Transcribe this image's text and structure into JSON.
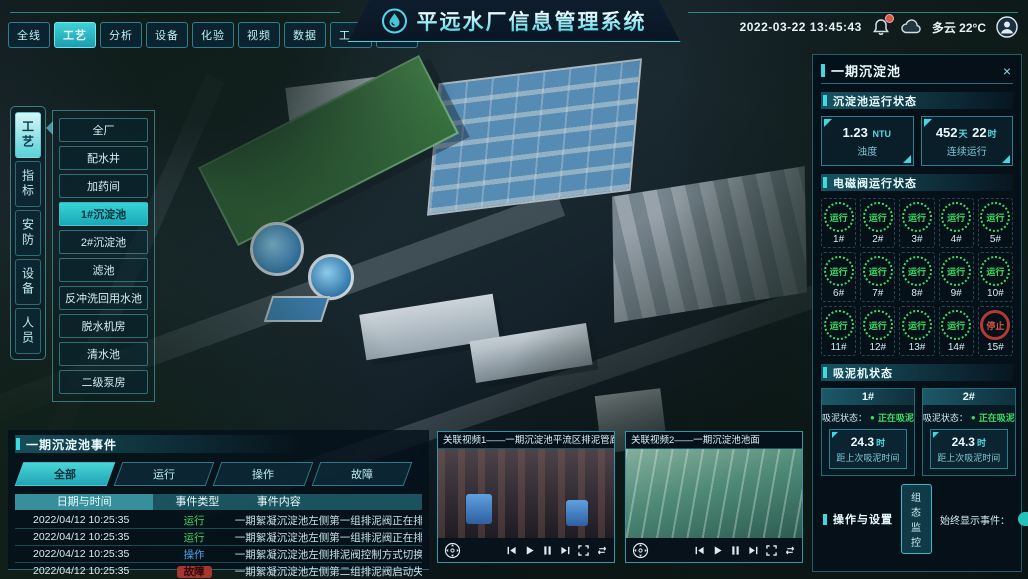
{
  "top_nav": {
    "tabs": [
      {
        "label": "全线",
        "active": false
      },
      {
        "label": "工艺",
        "active": true
      },
      {
        "label": "分析",
        "active": false
      },
      {
        "label": "设备",
        "active": false
      },
      {
        "label": "化验",
        "active": false
      },
      {
        "label": "视频",
        "active": false
      },
      {
        "label": "数据",
        "active": false
      },
      {
        "label": "工单",
        "active": false
      },
      {
        "label": "系统",
        "active": false
      }
    ],
    "title": "平远水厂信息管理系统",
    "datetime": "2022-03-22 13:45:43",
    "weather": "多云 22°C"
  },
  "left_nav": {
    "tabs": [
      {
        "label": "工艺",
        "active": true
      },
      {
        "label": "指标",
        "active": false
      },
      {
        "label": "安防",
        "active": false
      },
      {
        "label": "设备",
        "active": false
      },
      {
        "label": "人员",
        "active": false
      }
    ],
    "submenu": [
      {
        "label": "全厂",
        "active": false
      },
      {
        "label": "配水井",
        "active": false
      },
      {
        "label": "加药间",
        "active": false
      },
      {
        "label": "1#沉淀池",
        "active": true
      },
      {
        "label": "2#沉淀池",
        "active": false
      },
      {
        "label": "滤池",
        "active": false
      },
      {
        "label": "反冲洗回用水池",
        "active": false
      },
      {
        "label": "脱水机房",
        "active": false
      },
      {
        "label": "清水池",
        "active": false
      },
      {
        "label": "二级泵房",
        "active": false
      }
    ]
  },
  "right_panel": {
    "title": "一期沉淀池",
    "tank_status": {
      "title": "沉淀池运行状态",
      "turbidity": {
        "value": "1.23",
        "unit": "NTU",
        "label": "浊度"
      },
      "runtime": {
        "v1": "452",
        "u1": "天",
        "v2": "22",
        "u2": "时",
        "label": "连续运行"
      }
    },
    "valves": {
      "title": "电磁阀运行状态",
      "items": [
        {
          "id": "1#",
          "state": "运行",
          "status": "run"
        },
        {
          "id": "2#",
          "state": "运行",
          "status": "run"
        },
        {
          "id": "3#",
          "state": "运行",
          "status": "run"
        },
        {
          "id": "4#",
          "state": "运行",
          "status": "run"
        },
        {
          "id": "5#",
          "state": "运行",
          "status": "run"
        },
        {
          "id": "6#",
          "state": "运行",
          "status": "run"
        },
        {
          "id": "7#",
          "state": "运行",
          "status": "run"
        },
        {
          "id": "8#",
          "state": "运行",
          "status": "run"
        },
        {
          "id": "9#",
          "state": "运行",
          "status": "run"
        },
        {
          "id": "10#",
          "state": "运行",
          "status": "run"
        },
        {
          "id": "11#",
          "state": "运行",
          "status": "run"
        },
        {
          "id": "12#",
          "state": "运行",
          "status": "run"
        },
        {
          "id": "13#",
          "state": "运行",
          "status": "run"
        },
        {
          "id": "14#",
          "state": "运行",
          "status": "run"
        },
        {
          "id": "15#",
          "state": "停止",
          "status": "stop"
        }
      ]
    },
    "mud_suckers": {
      "title": "吸泥机状态",
      "items": [
        {
          "id": "1#",
          "state_label": "吸泥状态：",
          "state": "正在吸泥",
          "value": "24.3",
          "unit": "时",
          "label": "距上次吸泥时间"
        },
        {
          "id": "2#",
          "state_label": "吸泥状态：",
          "state": "正在吸泥",
          "value": "24.3",
          "unit": "时",
          "label": "距上次吸泥时间"
        }
      ]
    },
    "operations": {
      "title": "操作与设置",
      "button": "组态监控",
      "toggle_label": "始终显示事件：",
      "toggle_on": true
    }
  },
  "events_panel": {
    "title": "一期沉淀池事件",
    "tabs": [
      {
        "label": "全部",
        "active": true
      },
      {
        "label": "运行",
        "active": false
      },
      {
        "label": "操作",
        "active": false
      },
      {
        "label": "故障",
        "active": false
      }
    ],
    "columns": {
      "time": "日期与时间",
      "type": "事件类型",
      "content": "事件内容"
    },
    "rows": [
      {
        "time": "2022/04/12 10:25:35",
        "type": "运行",
        "status": "run",
        "content": "一期絮凝沉淀池左侧第一组排泥阀正在排泥"
      },
      {
        "time": "2022/04/12 10:25:35",
        "type": "运行",
        "status": "run",
        "content": "一期絮凝沉淀池左侧第一组排泥阀正在排泥"
      },
      {
        "time": "2022/04/12 10:25:35",
        "type": "操作",
        "status": "op",
        "content": "一期絮凝沉淀池左侧排泥阀控制方式切换为手动"
      },
      {
        "time": "2022/04/12 10:25:35",
        "type": "故障",
        "status": "fault",
        "content": "一期絮凝沉淀池左侧第二组排泥阀启动失败"
      }
    ]
  },
  "videos": [
    {
      "title": "关联视频1——一期沉淀池平流区排泥管廊"
    },
    {
      "title": "关联视频2——一期沉淀池池面"
    }
  ],
  "colors": {
    "accent": "#3fd9e0",
    "running_green": "#3ddb63",
    "stopped_red": "#d4554a",
    "operation_blue": "#4a9fe8",
    "panel_bg": "#04101a"
  }
}
